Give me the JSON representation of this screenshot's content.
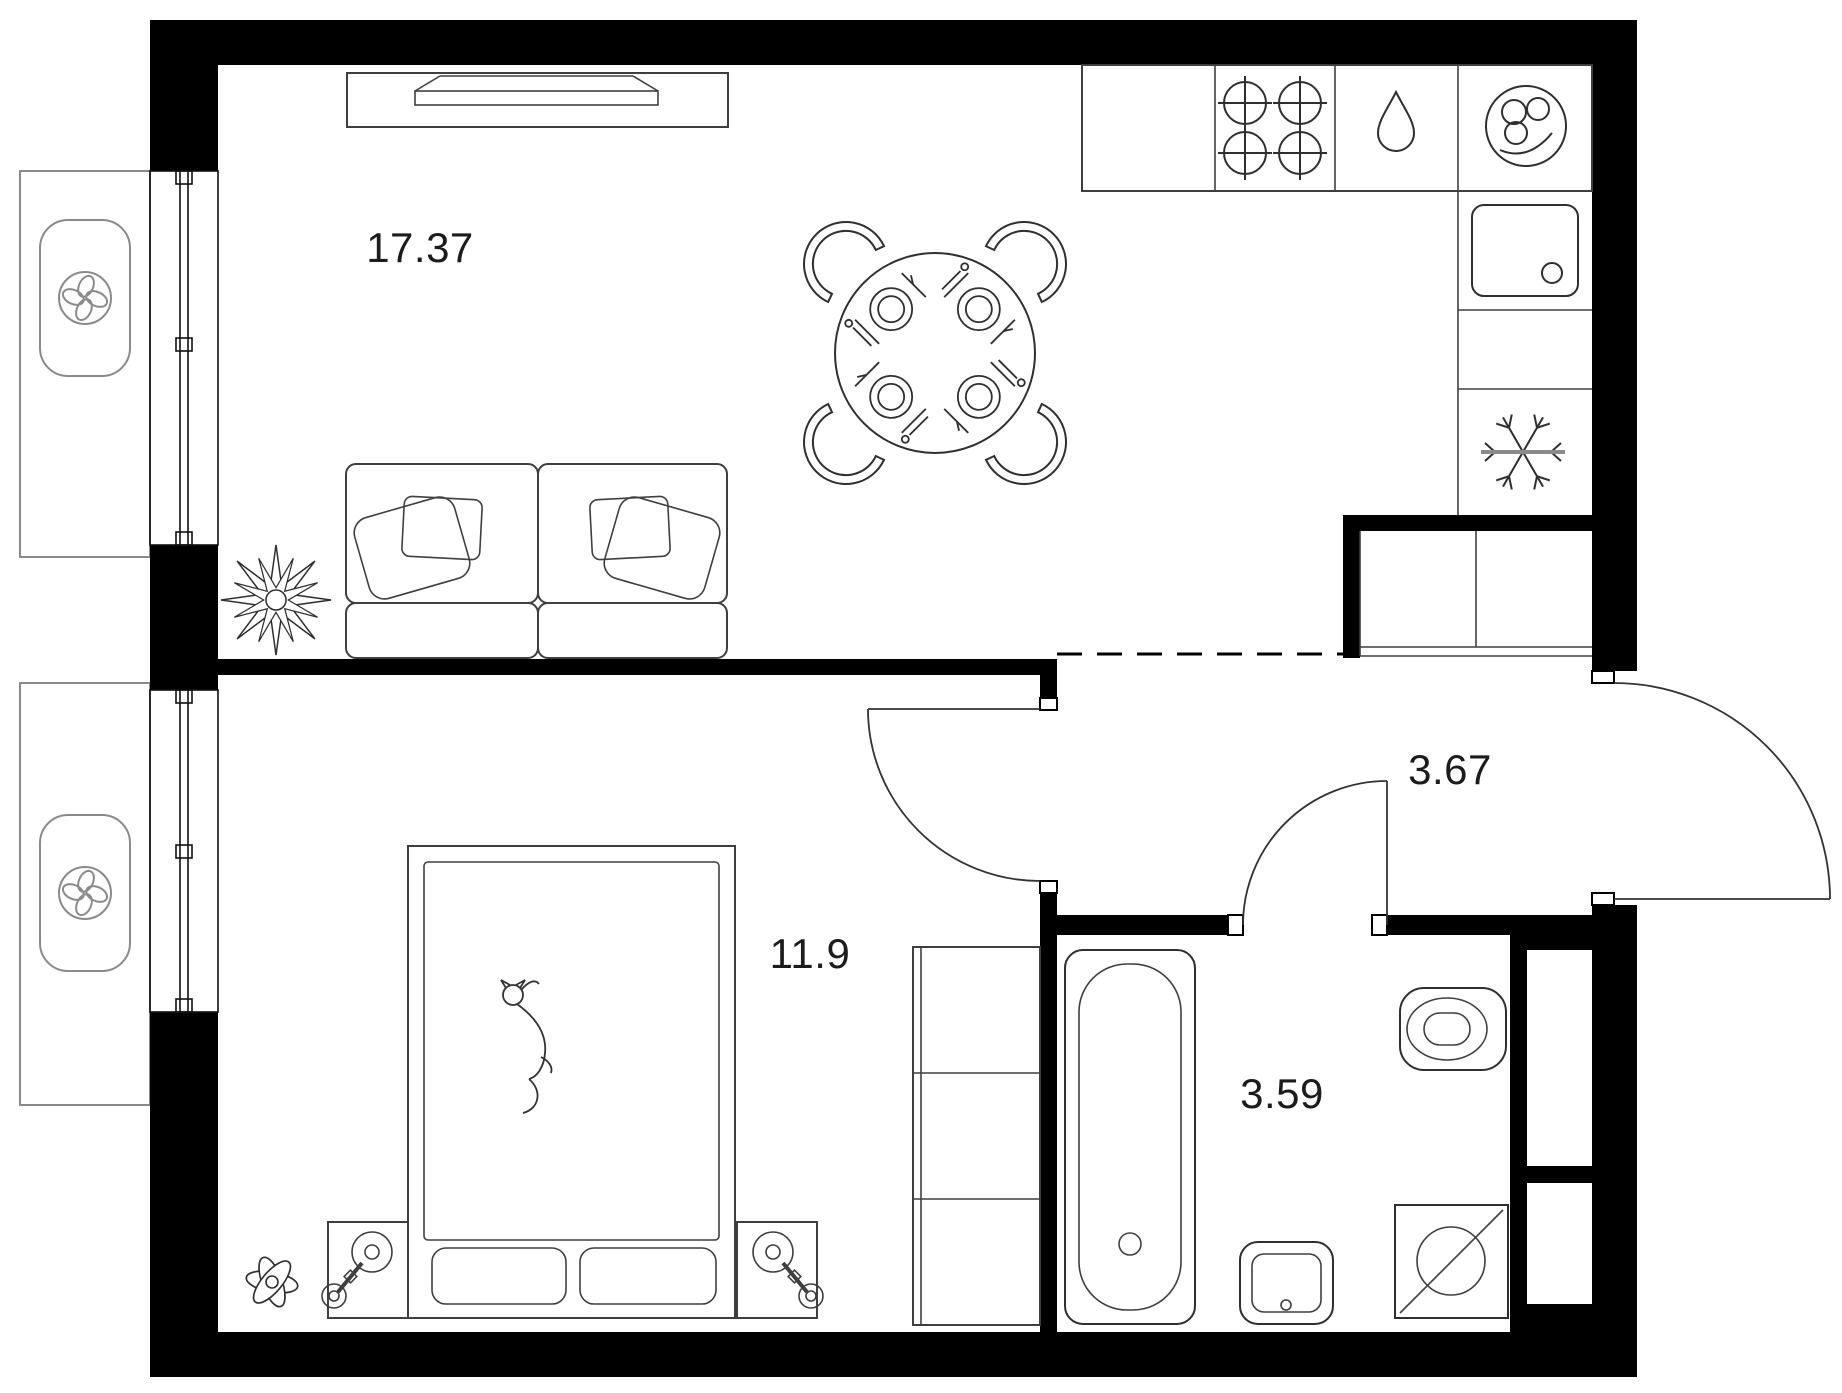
{
  "floor_plan": {
    "type": "apartment-floor-plan",
    "background": "#ffffff",
    "colors": {
      "walls": "#000000",
      "furniture_stroke": "#3f3f3f",
      "balcony_stroke": "#8a8a8a",
      "label_color": "#1c1c1c"
    },
    "rooms": [
      {
        "id": "living-kitchen",
        "area_label": "17.37"
      },
      {
        "id": "bedroom",
        "area_label": "11.9"
      },
      {
        "id": "hallway",
        "area_label": "3.67"
      },
      {
        "id": "bathroom",
        "area_label": "3.59"
      }
    ],
    "icons": [
      "fan-icon",
      "stove-burners-icon",
      "water-drop-icon",
      "kitchen-sink-icon",
      "snowflake-icon",
      "sink-basin-icon",
      "bathtub-icon",
      "toilet-icon",
      "washing-machine-icon",
      "bed-icon",
      "cat-icon",
      "dining-table-icon",
      "chair-icon",
      "sofa-icon",
      "tv-icon",
      "plant-icon",
      "lamp-icon",
      "wardrobe-icon",
      "door-swing-icon",
      "window-icon"
    ]
  }
}
